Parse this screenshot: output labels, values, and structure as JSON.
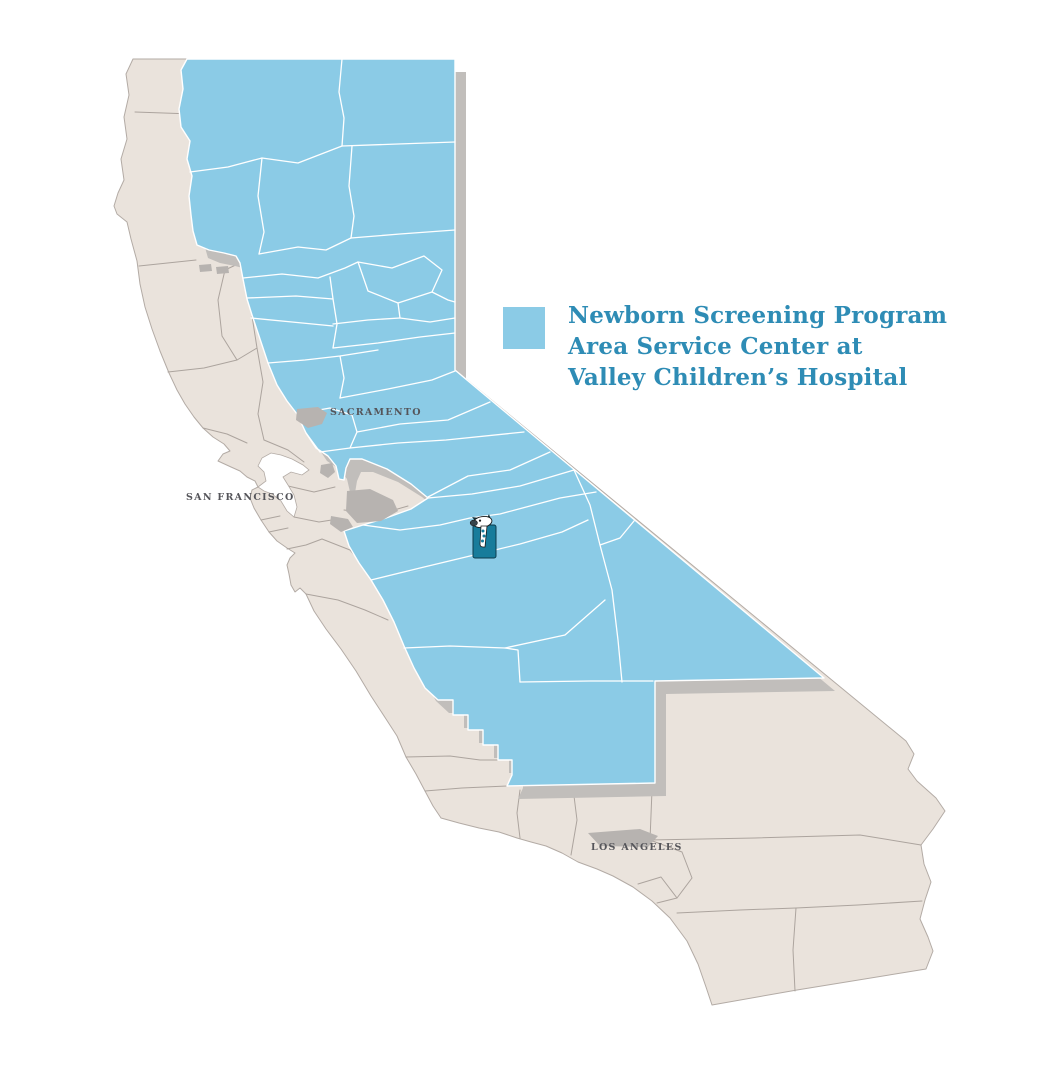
{
  "page": {
    "background_color": "#FFFFFF"
  },
  "legend": {
    "swatch_color": "#8BCBE6",
    "lines": [
      "Newborn Screening Program",
      "Area Service Center at",
      "Valley Children’s Hospital"
    ]
  },
  "map": {
    "city_labels": {
      "sacramento": "SACRAMENTO",
      "san_francisco": "SAN FRANCISCO",
      "los_angeles": "LOS ANGELES"
    },
    "colors": {
      "service_area": "#8BCBE6",
      "non_service_area": "#EAE3DC",
      "shadow": "#C1BEBB",
      "urban_area": "#B7B3B0",
      "county_border_light": "#FFFFFF",
      "county_border_dark": "#ACA49E",
      "water": "#FFFFFF",
      "legend_text": "#2E8CB5",
      "city_label": "#55555A",
      "marker_teal": "#177C9B",
      "marker_dark": "#0D3D4D"
    },
    "icons": {
      "hospital_marker": "giraffe-logo-icon"
    }
  }
}
